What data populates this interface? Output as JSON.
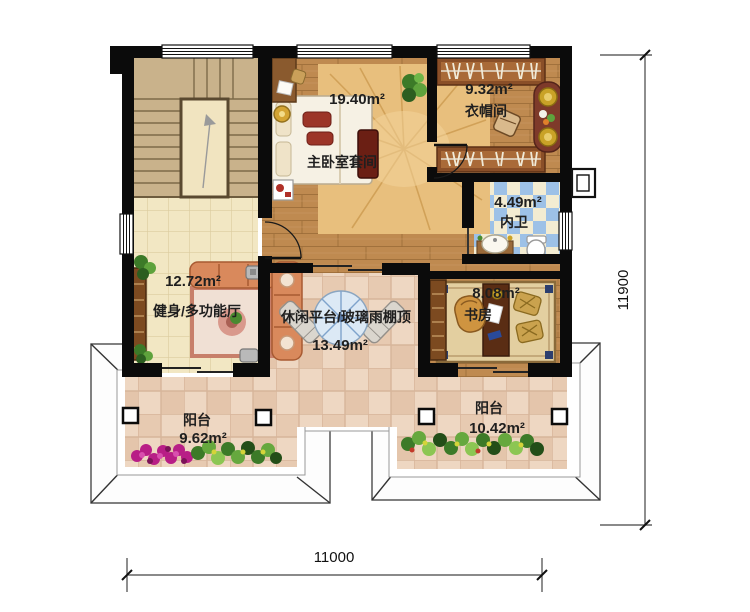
{
  "plan": {
    "title": "second-floor-plan",
    "rooms": {
      "master": {
        "area": "19.40m²",
        "name": "主卧室套间"
      },
      "cloak": {
        "area": "9.32m²",
        "name": "衣帽间"
      },
      "bath": {
        "area": "4.49m²",
        "name": "内卫"
      },
      "study": {
        "area": "8.08m²",
        "name": "书房"
      },
      "gym": {
        "area": "12.72m²",
        "name": "健身/多功能厅"
      },
      "terrace": {
        "area": "13.49m²",
        "name": "休闲平台/玻璃雨棚顶"
      },
      "balcony_left": {
        "area": "9.62m²",
        "name": "阳台"
      },
      "balcony_right": {
        "area": "10.42m²",
        "name": "阳台"
      }
    },
    "dimensions": {
      "width": "11000",
      "height": "11900"
    },
    "colors": {
      "wall": "#0b0b0b",
      "wood_floor": "#bf8a50",
      "cream_tile": "#f2e7c3",
      "terrace_tile": "#eed7c2",
      "bath_blue": "#9dc1e7",
      "stair_beige": "#c9b28b",
      "roof_line": "#4a4a4a"
    }
  }
}
